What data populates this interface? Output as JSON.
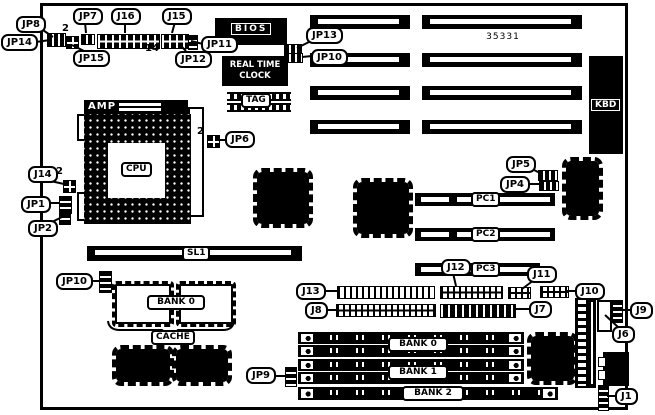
{
  "board": {
    "part_number": "35331"
  },
  "callouts": {
    "jp8": "JP8",
    "jp14": "JP14",
    "jp7": "JP7",
    "j16": "J16",
    "j15": "J15",
    "jp15": "JP15",
    "jp12": "JP12",
    "jp11": "JP11",
    "jp13": "JP13",
    "jp10_top": "JP10",
    "jp6": "JP6",
    "j14": "J14",
    "jp1": "JP1",
    "jp2": "JP2",
    "jp5": "JP5",
    "jp4": "JP4",
    "jp10_bottom": "JP10",
    "j13": "J13",
    "j8": "J8",
    "j12": "J12",
    "j11": "J11",
    "j10": "J10",
    "j7": "J7",
    "j9": "J9",
    "j6": "J6",
    "jp9": "JP9",
    "j1": "J1"
  },
  "chips": {
    "bios": "BIOS",
    "rtc_line1": "REAL TIME",
    "rtc_line2": "CLOCK",
    "tag": "TAG",
    "kbd": "KBD",
    "amp": "AMP",
    "cpu": "CPU"
  },
  "slots": {
    "sl1": "SL1",
    "pc1": "PC1",
    "pc2": "PC2",
    "pc3": "PC3"
  },
  "memory": {
    "cache_bank": "BANK 0",
    "cache": "CACHE",
    "bank0": "BANK 0",
    "bank1": "BANK 1",
    "bank2": "BANK 2"
  },
  "pin_labels": {
    "jp15_pin2": "2",
    "jp6_pin2": "2",
    "j14_pin2": "2",
    "j16_pin14": "14"
  },
  "colors": {
    "ink": "#000000",
    "paper": "#ffffff"
  }
}
